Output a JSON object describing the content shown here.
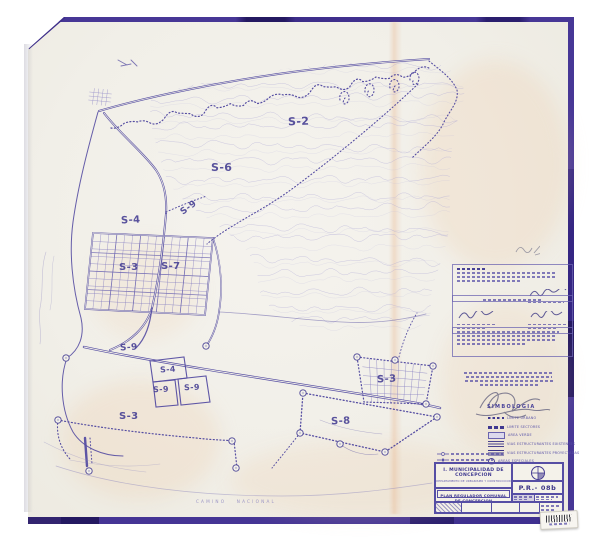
{
  "map": {
    "zone_labels": [
      {
        "text": "S-2"
      },
      {
        "text": "S-6"
      },
      {
        "text": "S-9"
      },
      {
        "text": "S-4"
      },
      {
        "text": "S-3"
      },
      {
        "text": "S-7"
      },
      {
        "text": "S-9"
      },
      {
        "text": "S-4"
      },
      {
        "text": "S-9"
      },
      {
        "text": "S-9"
      },
      {
        "text": "S-3"
      },
      {
        "text": "S-3"
      },
      {
        "text": "S-8"
      }
    ],
    "caption_bottom": "CAMINO NACIONAL"
  },
  "legend": {
    "heading": "SIMBOLOGIA",
    "items": [
      {
        "label": "LIMITE URBANO"
      },
      {
        "label": "LIMITE SECTORES"
      },
      {
        "label": "AREA VERDE"
      },
      {
        "label": "VIAS ESTRUCTURANTES EXISTENTES"
      },
      {
        "label": "VIAS ESTRUCTURANTES PROYECTADAS"
      },
      {
        "label": "AREAS ESPECIALES"
      }
    ]
  },
  "title_block": {
    "municipality": "I. MUNICIPALIDAD DE CONCEPCION",
    "department": "DEPARTAMENTO DE URBANISMO Y CONSTRUCCION",
    "plan_title": "PLAN REGULADOR COMUNAL DE CONCEPCION",
    "sheet_code": "P.R.- 08b"
  },
  "colors": {
    "border_purple": "#3a2b80",
    "map_ink": "#554da2",
    "label_ink": "#433c92",
    "paper": "#f1efe8"
  }
}
